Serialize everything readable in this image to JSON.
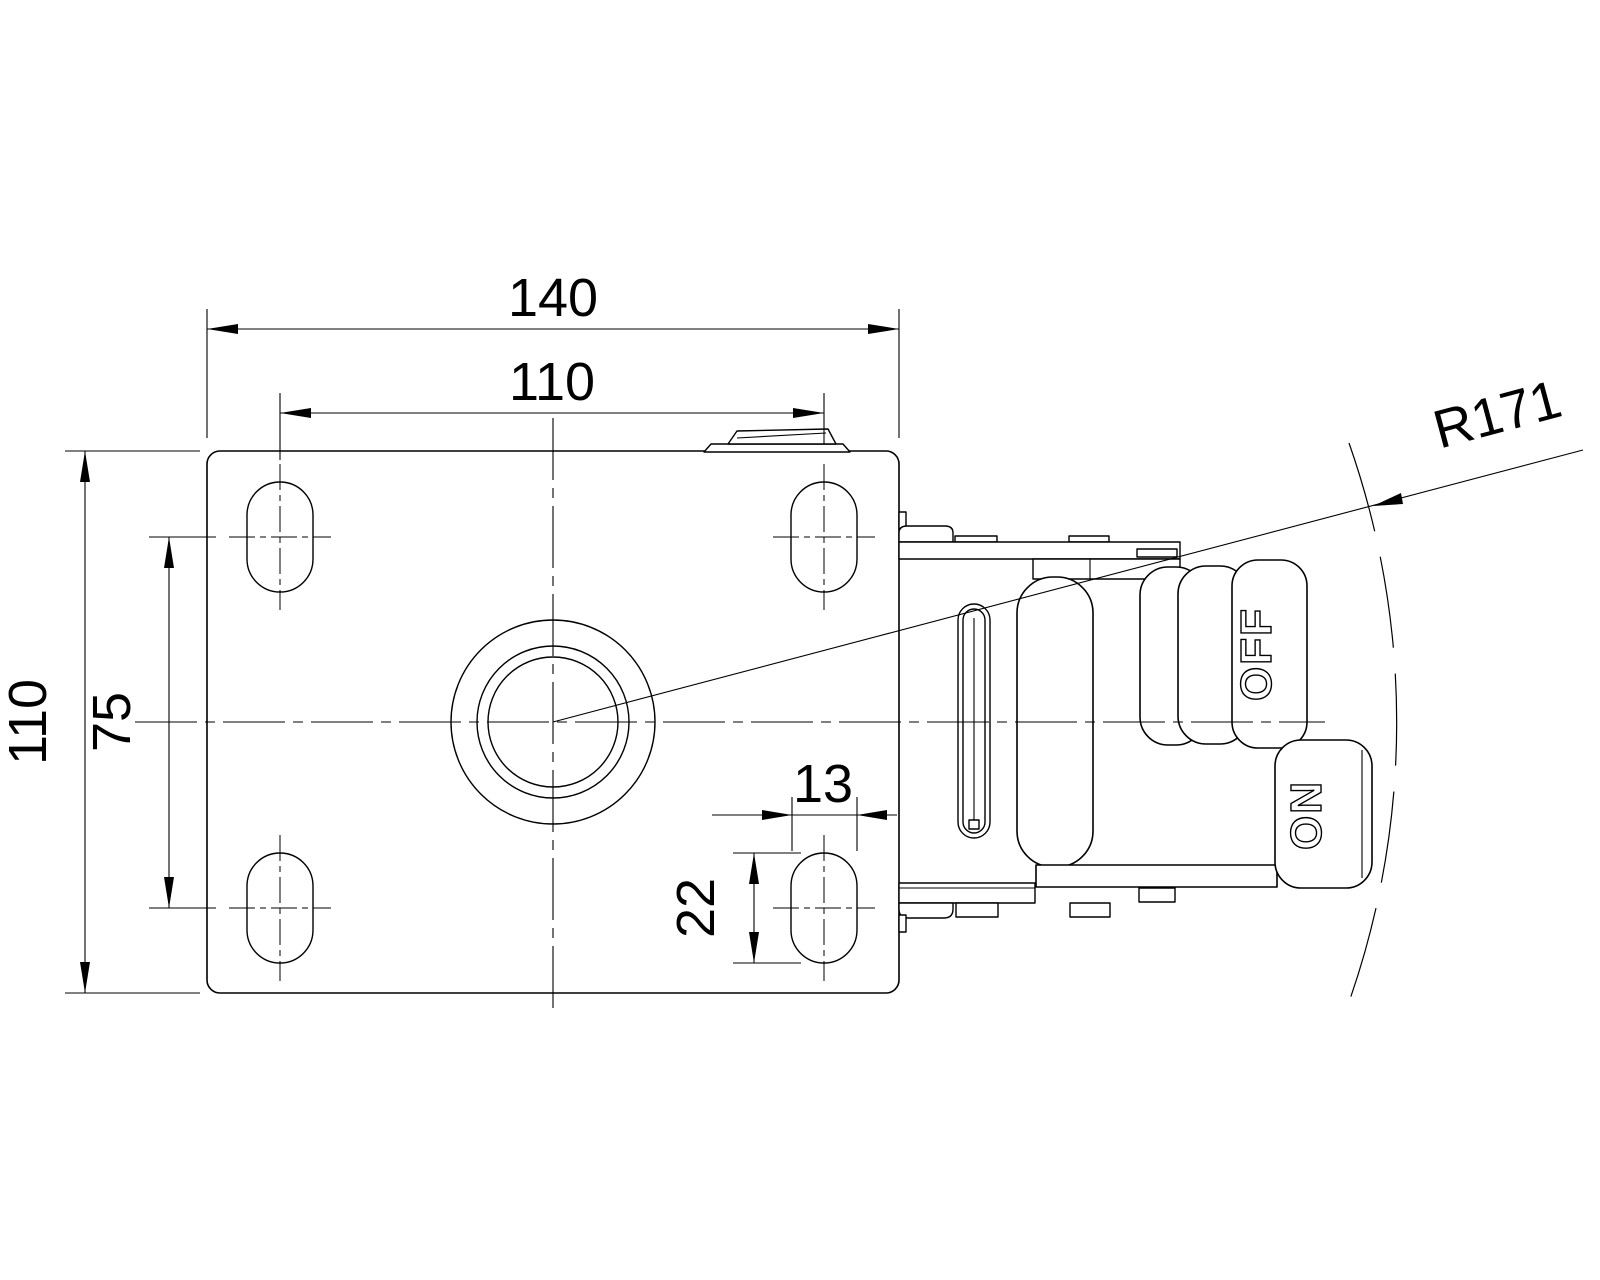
{
  "meta": {
    "background": "#ffffff",
    "line_color": "#000000",
    "drawing_type": "caster-mounting-plate-top-view"
  },
  "dims": {
    "plate_width": "140",
    "hole_spacing_x": "110",
    "plate_depth": "110",
    "hole_spacing_y": "75",
    "slot_width": "13",
    "slot_length": "22",
    "swivel_radius": "R171"
  },
  "pedals": {
    "off": "OFF",
    "on": "ON"
  }
}
